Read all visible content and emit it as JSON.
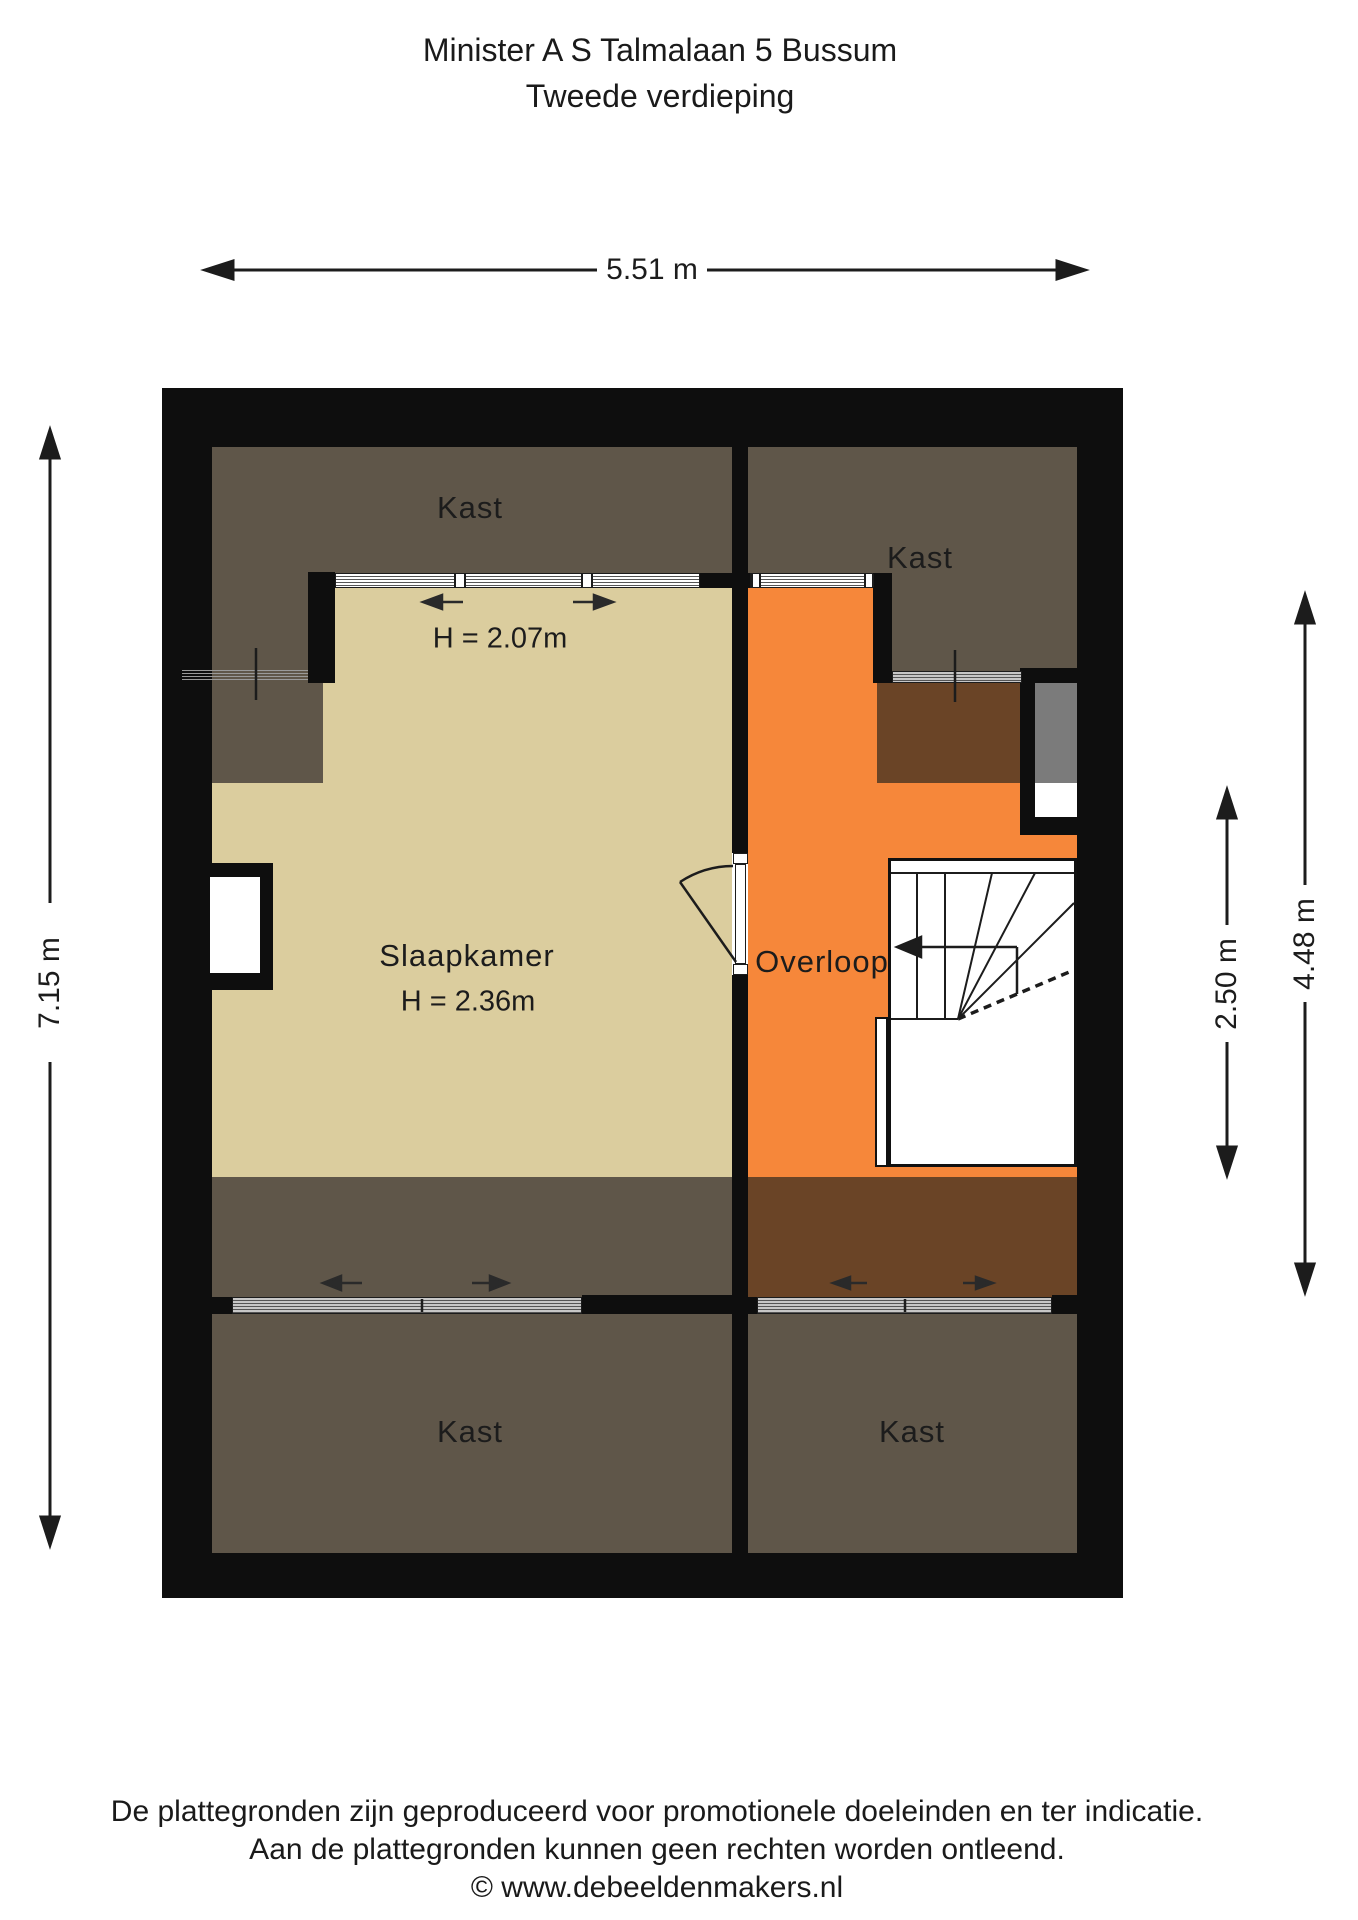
{
  "title": {
    "line1": "Minister A S Talmalaan 5 Bussum",
    "line2": "Tweede verdieping"
  },
  "rooms": {
    "kast_top_left": "Kast",
    "kast_top_right": "Kast",
    "kast_bottom_left": "Kast",
    "kast_bottom_right": "Kast",
    "slaapkamer": "Slaapkamer",
    "overloop": "Overloop"
  },
  "ceiling_heights": {
    "upper": "H = 2.07m",
    "slaapkamer": "H = 2.36m"
  },
  "dimensions": {
    "top_width": "5.51 m",
    "left_height": "7.15 m",
    "right_inner": "2.50 m",
    "right_outer": "4.48 m"
  },
  "footer": {
    "line1": "De plattegronden zijn geproduceerd voor promotionele doeleinden en ter indicatie.",
    "line2": "Aan de plattegronden kunnen geen rechten worden ontleend.",
    "line3": "© www.debeeldenmakers.nl"
  },
  "colors": {
    "wall": "#0e0e0e",
    "closet_floor": "#5f5649",
    "bedroom_floor": "#dbcd9e",
    "landing_floor": "#f6873a",
    "eaves_floor": "#6a4426",
    "shaft_gray": "#7b7b7b"
  }
}
